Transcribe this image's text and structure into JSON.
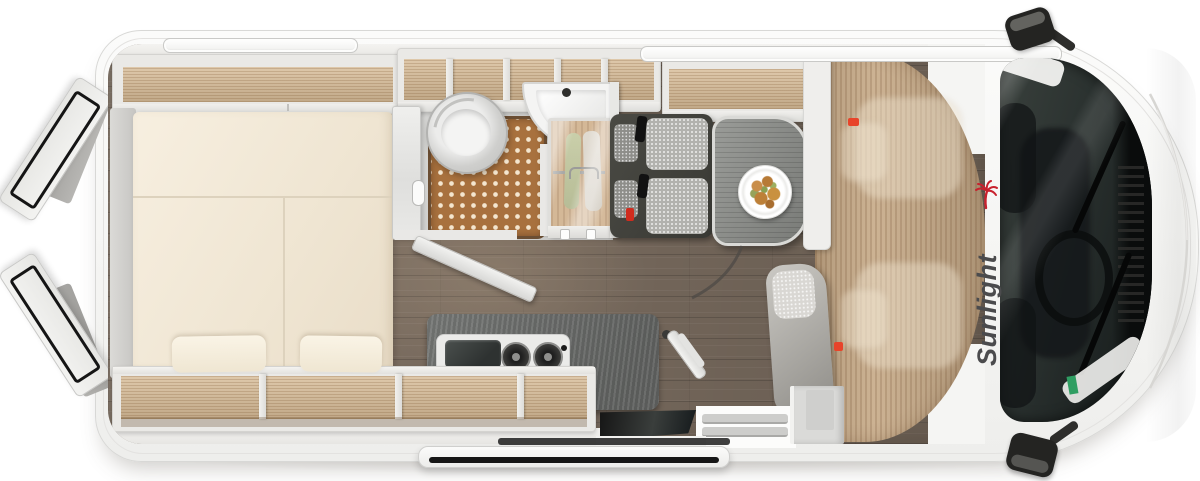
{
  "window": {
    "width_px": 1200,
    "height_px": 481,
    "background": "#ffffff"
  },
  "subject": {
    "kind": "top-down 3D rendered floor plan of a camper van",
    "open_elements": [
      "rear-door-upper",
      "rear-door-lower",
      "sliding-door",
      "bathroom-door"
    ]
  },
  "brand": {
    "logo_text": "Sunlight",
    "logo_text_color": "#4b4b4d",
    "palm_icon_color": "#c8222e"
  },
  "palette": {
    "body_white": "#f6f6f4",
    "wall_grey": "#e9e8e5",
    "wood_light_oak": "#d7bc98",
    "wood_cab_floor": "#c4a987",
    "floor_dark_wood": "#7b6d60",
    "mattress_cream": "#f2e9d8",
    "counter_grey": "#767876",
    "shower_mat_brown": "#a8713e",
    "upholstery_grey": "#b2b2ae",
    "glass_dark": "#242a28",
    "seatbelt_red": "#d02c1e",
    "sticker_green": "#2f9e62"
  },
  "objects": [
    {
      "name": "rear-double-bed",
      "detail": "split cream mattress, two pillows, side shelves"
    },
    {
      "name": "overhead-storage-shelves",
      "detail": "open wood-lined compartments along both walls"
    },
    {
      "name": "bathroom",
      "detail": "round swivel toilet, corner washbasin, dotted shower mat, frosted door"
    },
    {
      "name": "wardrobe",
      "detail": "two garments hanging behind frosted glass, towel hooks"
    },
    {
      "name": "kitchen-block",
      "detail": "dark worktop with combined sink and two-burner hob, faucet"
    },
    {
      "name": "dinette",
      "detail": "two-seat belted bench and grey table with plate of food"
    },
    {
      "name": "cab",
      "detail": "swivel seats, red belt buckles, windshield with wipers, two mirrors"
    },
    {
      "name": "entry-step",
      "detail": "open sliding door with step rails"
    },
    {
      "name": "roof-vents",
      "count": 2
    }
  ]
}
